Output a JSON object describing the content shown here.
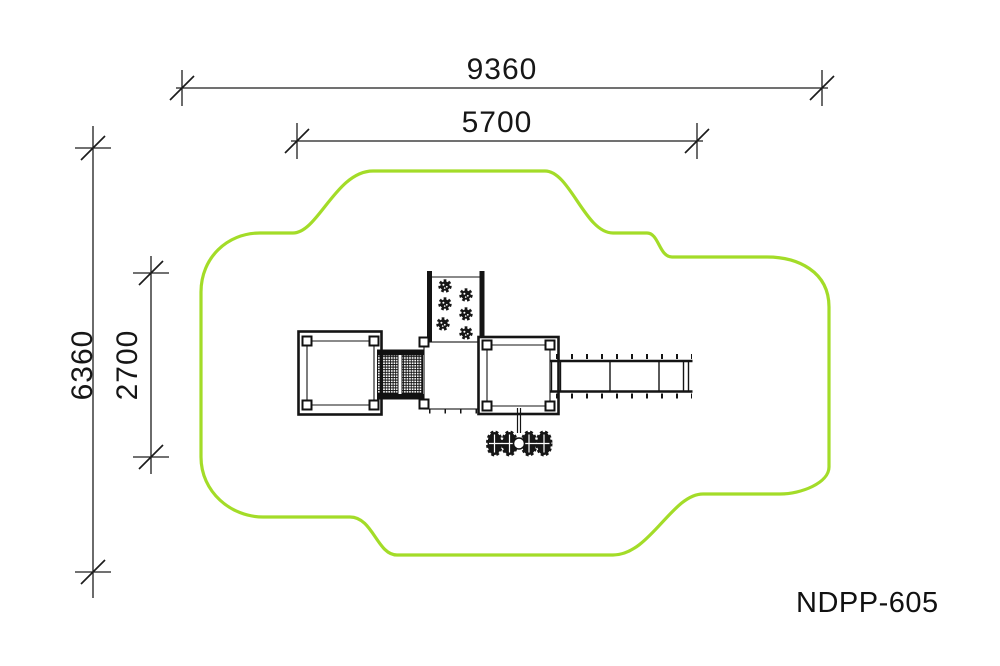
{
  "drawing": {
    "model_label": "NDPP-605",
    "colors": {
      "safety_zone_green": "#a3dc28",
      "linework_black": "#141414",
      "background": "#ffffff"
    },
    "dimensions": {
      "overall_width": {
        "value": "9360",
        "orientation": "horizontal"
      },
      "inner_width": {
        "value": "5700",
        "orientation": "horizontal"
      },
      "overall_height": {
        "value": "6360",
        "orientation": "vertical"
      },
      "inner_height": {
        "value": "2700",
        "orientation": "vertical"
      }
    },
    "components": [
      "safety-zone-outline",
      "left-platform",
      "net-bridge",
      "climbing-wall",
      "central-deck",
      "right-platform",
      "overhead-ladder",
      "spring-rider"
    ]
  }
}
